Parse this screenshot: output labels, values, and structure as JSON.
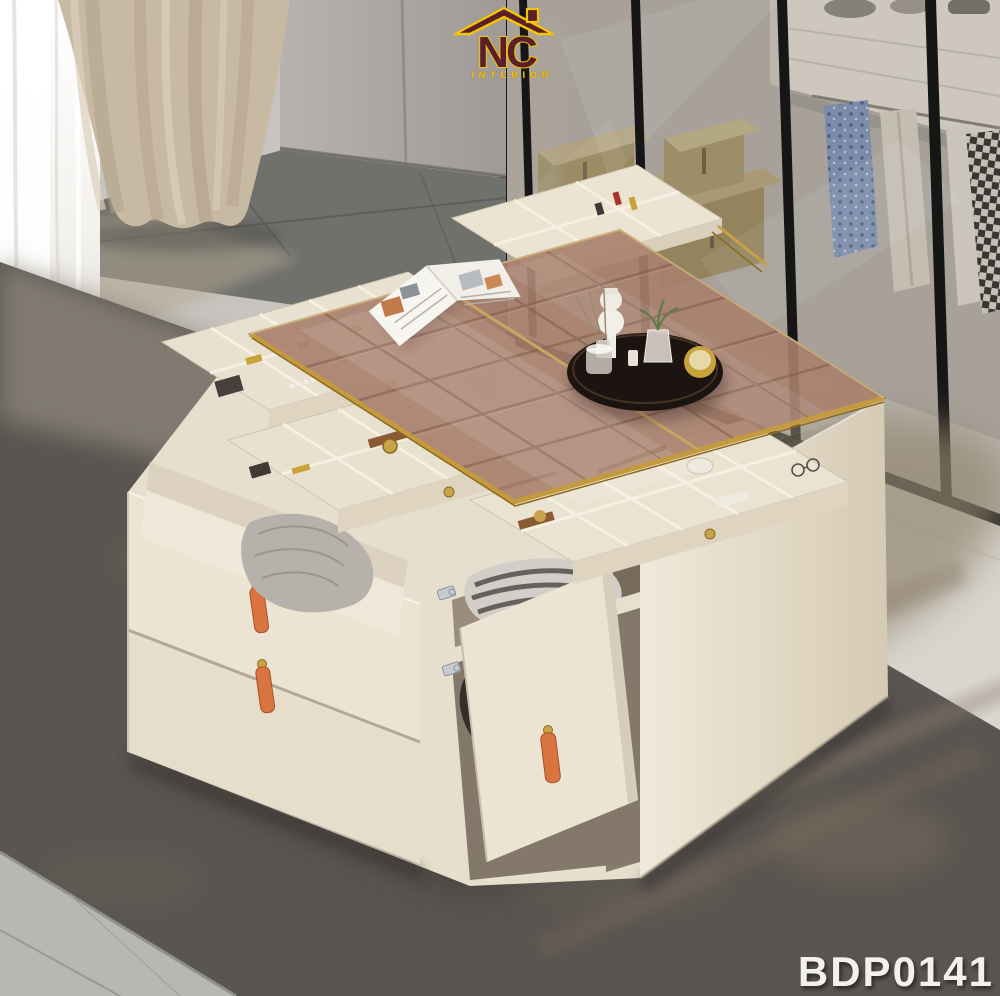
{
  "branding": {
    "logo_text": "NC",
    "logo_subtext": "INTERIOR",
    "product_code": "BDP0141"
  },
  "palette": {
    "logo_maroon": "#5a1f2b",
    "logo_yellow": "#f2c500",
    "code_white": "#f3f1ee",
    "table_cream": "#e9e1d0",
    "glass_bronze": "#a8806d",
    "gold_trim": "#c49a3f",
    "leather_orange": "#d97340",
    "rug_dark": "#5a5550",
    "rug_sunlit": "#93866f",
    "tile_dark": "#70706c",
    "tile_light": "#b7b8b4",
    "floor_white": "#d9d5cf",
    "curtain_beige": "#c8b9a3",
    "curtain_sheer": "#ffffff",
    "wardrobe_frame": "#161616",
    "storage_box_tan": "#a8986a",
    "scarf_blue": "#8199c2"
  },
  "scene": {
    "objects": [
      "sheer-curtain",
      "beige-curtain",
      "wall-cabinet",
      "wardrobe-glass-doors",
      "storage-boxes",
      "hanging-scarves",
      "white-drawer-cabinet",
      "dark-tile-floor",
      "white-floor-strip",
      "light-tile-floor",
      "gray-rug",
      "vanity-storage-island",
      "tinted-glass-top",
      "jewelry-trays",
      "cosmetics-drawer",
      "open-blanket-drawer",
      "open-cabinet-door",
      "folded-clothes",
      "leather-pulls",
      "decor-tray",
      "magazine"
    ]
  }
}
